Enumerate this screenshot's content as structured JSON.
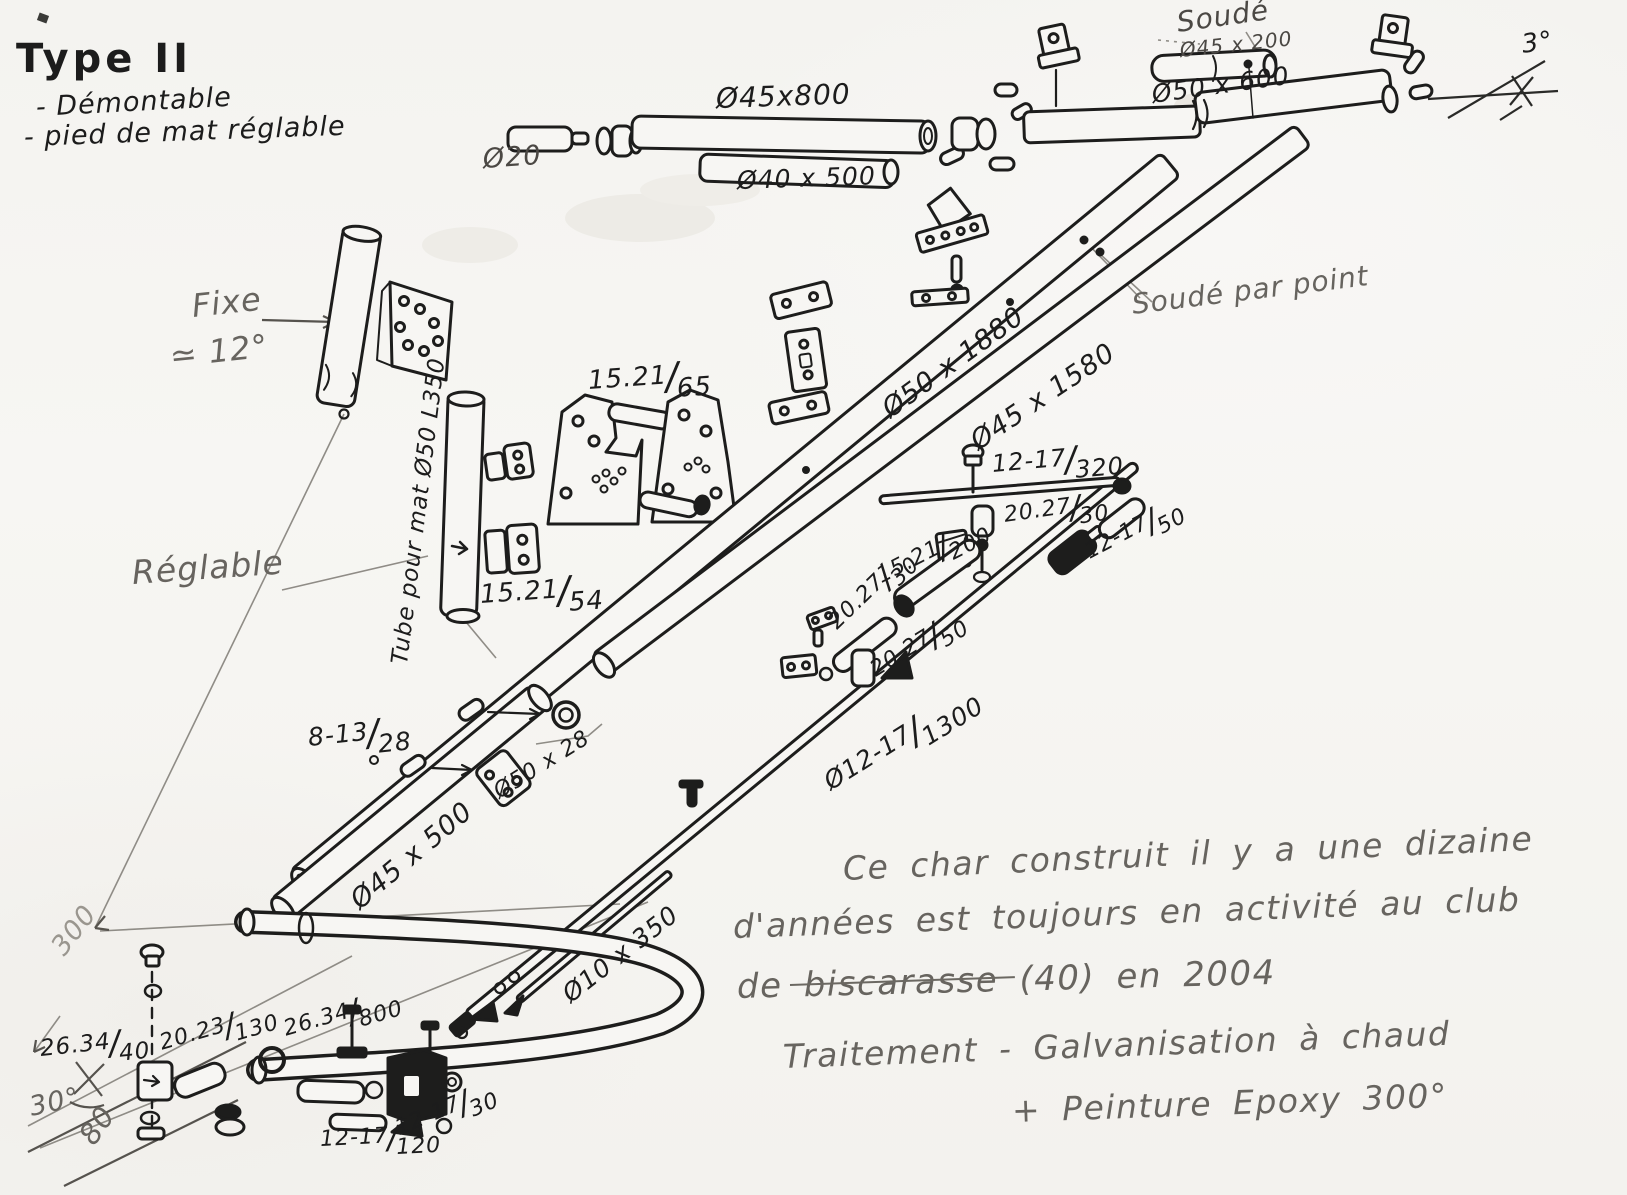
{
  "colors": {
    "paper": "#f6f5f2",
    "ink": "#1c1c1c",
    "pencil": "#67645f"
  },
  "header": {
    "title": "Type II",
    "features": [
      "- Démontable",
      "- pied de mat réglable"
    ]
  },
  "annotations": {
    "dia20": "Ø20",
    "dia45x800": "Ø45x800",
    "dia40x500": "Ø40 x 500",
    "soude": "Soudé",
    "dia45x200": "Ø45 x 200",
    "dia50x600": "Ø50 x 600",
    "deg3": "3°",
    "fixe": "Fixe",
    "approx12": "≃ 12°",
    "tube_mat": "Tube pour mat Ø50 L350",
    "f15_21_65": "15.21/65",
    "f15_21_54": "15.21/54",
    "reglable": "Réglable",
    "dia50x1880": "Ø50 x 1880",
    "dia45x1580": "Ø45 x 1580",
    "soude_point": "Soudé par point",
    "f12_17_320": "12-17/320",
    "f20_27_30a": "20.27/30",
    "f12_17_50": "12-17/50",
    "f15_21_200": "15.21/200",
    "f20_27_30b": "20.27/30",
    "f20_27_50": "20.27/50",
    "f8_13_28": "8-13/28",
    "dia50x28": "Ø50 x 28",
    "dia45x500": "Ø45 x 500",
    "dia12_17_1300": "Ø12-17/1300",
    "dia10x350": "Ø10 x 350",
    "dim300": "300",
    "f26_34_40": "26.34/40",
    "f20_23_130": "20.23/130",
    "f26_34_800": "26.34/800",
    "deg30": "30°",
    "dim80": "80",
    "f12_17_120": "12-17/120",
    "f12_17_30": "12-17/30"
  },
  "notes": {
    "line1": "Ce char construit il y a une dizaine",
    "line2": "d'années est toujours en activité au club",
    "line3": "de biscarasse (40) en 2004",
    "line4": "Traitement - Galvanisation à chaud",
    "line5": "+ Peinture Epoxy 300°"
  }
}
